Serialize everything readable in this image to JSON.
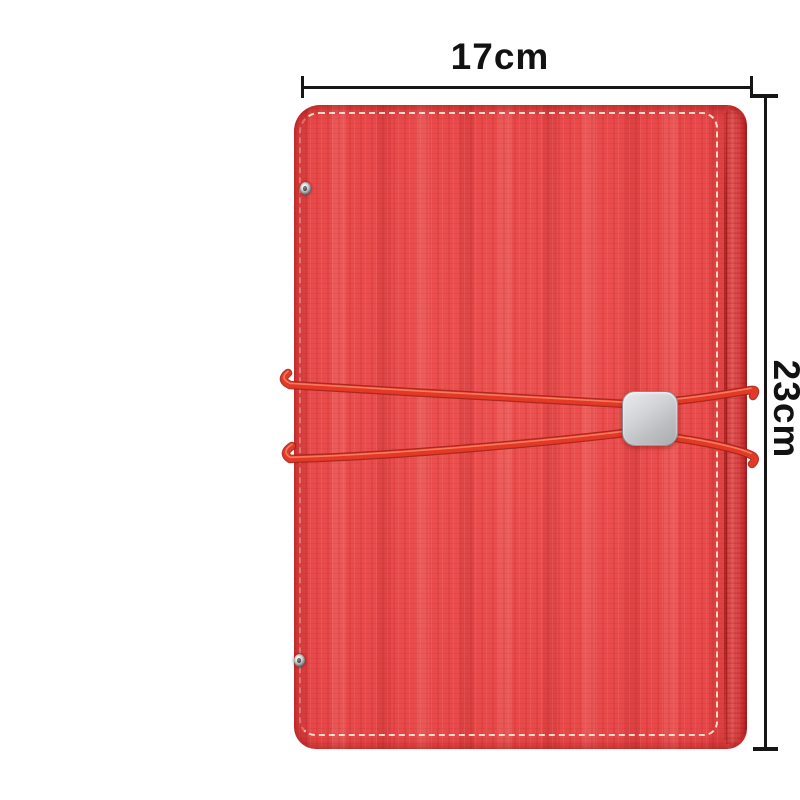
{
  "image_type": "annotated product photo",
  "product": {
    "name": "red faux-leather notebook cover with elastic band closure",
    "cover_color": "#e8494a",
    "band_color": "#e23a26",
    "buckle_color": "#c7c8cc",
    "stitch_color": "#f3ead6",
    "rivet_color": "#aeb1b3"
  },
  "dimensions": {
    "width_label": "17cm",
    "height_label": "23cm",
    "line_color": "#161616"
  },
  "background_color": "#ffffff"
}
